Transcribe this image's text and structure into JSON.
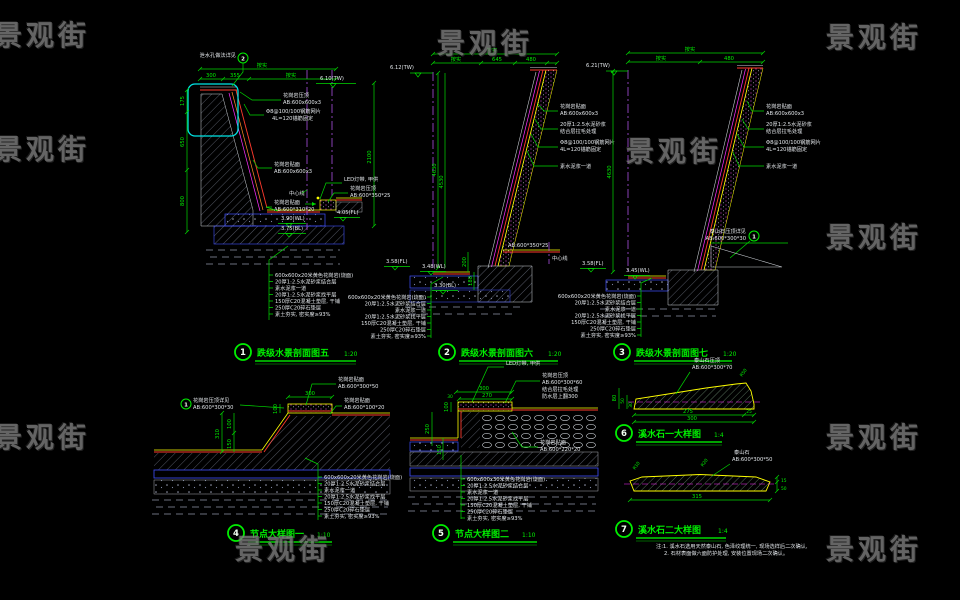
{
  "watermark": "景观街",
  "notes20": [
    "600x600x20米黄色花岗岩(烧面)",
    "20厚1:2.5水泥砂浆结合层",
    "素水泥浆一道",
    "20厚1:2.5水泥砂浆找平层",
    "150厚C20混凝土垫层, 干铺",
    "250厚C20碎石垫层",
    "素土夯实, 密实度≥93%"
  ],
  "notes30": [
    "600x600x30米黄色花岗岩(烧面)",
    "20厚1:2.5水泥砂浆结合层",
    "素水泥浆一道",
    "20厚1:2.5水泥砂浆找平层",
    "150厚C20混凝土垫层, 干铺",
    "250厚C20碎石垫层",
    "素土夯实, 密实度≥93%"
  ],
  "d1": {
    "num": "1",
    "title": "跌级水景剖面图五",
    "scale": "1:20",
    "callout_num": "2",
    "callout": "泄水孔做法详见",
    "overall": "按实",
    "w1": "300",
    "w2": "355",
    "w3": "按实",
    "h1": "175",
    "h2": "650",
    "h3": "800",
    "hr": "2100",
    "tw": "6.10(TW)",
    "fl": "4.05(FL)",
    "wl": "3.90(WL)",
    "bl": "3.75(BL)",
    "cap1a": "花岗岩压顶",
    "cap1b": "AB:600x600x3",
    "mesha": "Φ8@100/100钢筋网片",
    "meshb": "4L=120锚筋固定",
    "facea": "花岗岩贴面",
    "faceb": "AB:600x600x3",
    "center": "中心线",
    "spouta": "花岗岩贴面",
    "spoutb": "AB:600*310*20",
    "led": "LED灯带, 甲供",
    "cap2a": "花岗岩压顶",
    "cap2b": "AB:600*350*25"
  },
  "d2": {
    "num": "2",
    "title": "跌级水景剖面图六",
    "scale": "1:20",
    "overall": "按实",
    "w1": "按实",
    "w2": "645",
    "w3": "480",
    "h1": "4630",
    "h2": "4530",
    "tw": "6.12(TW)",
    "fl": "3.58(FL)",
    "wl": "3.48(WL)",
    "bl": "3.30(BL)",
    "d200": "200",
    "d180": "180",
    "facea": "花岗岩贴面",
    "faceb": "AB:600x600x3",
    "mortara": "20厚1:2.5水泥砂浆",
    "mortarb": "结合层拉毛处理",
    "mesha": "Φ8@100/100钢筋网片",
    "meshb": "4L=120锚筋固定",
    "plain": "素水泥浆一道",
    "cap": "AB:600*350*25",
    "center": "中心线"
  },
  "d3": {
    "num": "3",
    "title": "跌级水景剖面图七",
    "scale": "1:20",
    "overall": "按实",
    "w1": "按实",
    "w2": "480",
    "h1": "4630",
    "tw": "6.21(TW)",
    "fl": "3.58(FL)",
    "wl": "3.45(WL)",
    "facea": "花岗岩贴面",
    "faceb": "AB:600x600x3",
    "mortara": "20厚1:2.5水泥砂浆",
    "mortarb": "结合层拉毛处理",
    "mesha": "Φ8@100/100钢筋网片",
    "meshb": "4L=120锚筋固定",
    "plain": "素水泥浆一道",
    "callout_num": "1",
    "callouta": "泰山石压顶详见",
    "calloutb": "AB:600*300*30"
  },
  "d4": {
    "num": "4",
    "title": "节点大样图一",
    "scale": "1:10",
    "callout_num": "1",
    "callouta": "花岗岩压顶详见",
    "calloutb": "AB:600*300*30",
    "w300": "300",
    "v310": "310",
    "v150": "150",
    "v100a": "100",
    "v100b": "100",
    "face1a": "花岗岩贴面",
    "face1b": "AB:600*300*50",
    "face2a": "花岗岩贴面",
    "face2b": "AB:600*100*20"
  },
  "d5": {
    "num": "5",
    "title": "节点大样图二",
    "scale": "1:10",
    "led": "LED灯带, 甲供",
    "cap1": "花岗岩压顶",
    "cap2": "AB:600*300*60",
    "cap3": "结合层拉毛处理",
    "cap4": "防水层上翻300",
    "w300": "300",
    "w270": "270",
    "w30": "30",
    "v250": "250",
    "v150": "150",
    "v100": "100",
    "facea": "花岗岩贴面",
    "faceb": "AB:600*220*20"
  },
  "d6": {
    "num": "6",
    "title": "溪水石一大样图",
    "scale": "1:4",
    "stonea": "泰山石压顶",
    "stoneb": "AB:600*300*70",
    "w275": "275",
    "w25": "25",
    "w300": "300",
    "h80": "80",
    "h50": "50",
    "h30": "30",
    "r50": "R50"
  },
  "d7": {
    "num": "7",
    "title": "溪水石二大样图",
    "scale": "1:4",
    "stonea": "泰山石",
    "stoneb": "AB:600*300*50",
    "w315": "315",
    "h15": "15",
    "h50": "50",
    "r10": "R10",
    "r20": "R20",
    "note1": "注:1. 溪水石选用天然泰山石, 色泽纹理统一, 现场选样后二次确认,",
    "note2": "2. 石材表面做六面防护处理, 安装位置现场二次确认。"
  }
}
